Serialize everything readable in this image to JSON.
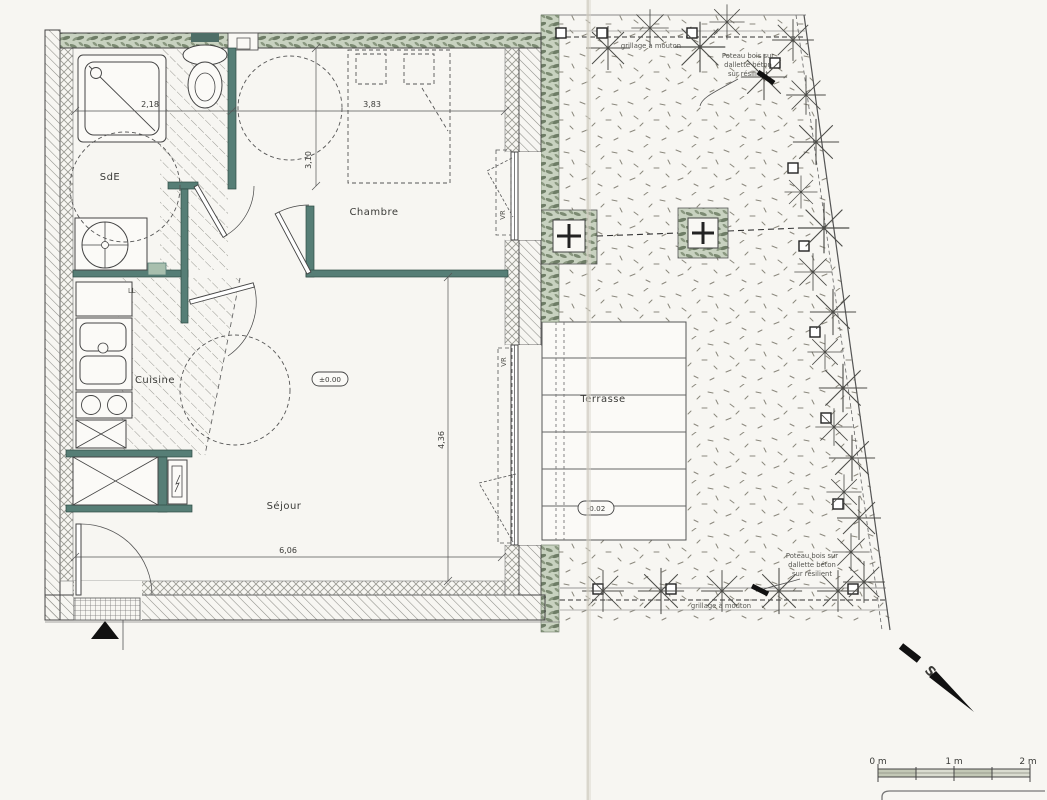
{
  "drawing": {
    "rooms": {
      "sde": "SdE",
      "chambre": "Chambre",
      "cuisine": "Cuisine",
      "sejour": "Séjour",
      "terrasse": "Terrasse"
    },
    "fixtures": {
      "washing_machine": "LL"
    },
    "dimensions": {
      "sde_width": "2,18",
      "chambre_width": "3,83",
      "chambre_depth": "3,10",
      "sejour_depth": "4,36",
      "sejour_width": "6,06"
    },
    "levels": {
      "ground_floor": "±0.00",
      "terrace": "-0.02"
    },
    "annotations": {
      "fence": "grillage à mouton",
      "post_line1": "Poteau bois sur",
      "post_line2": "dallette béton",
      "post_line3": "sur résilient",
      "roller_shutter": "VR"
    },
    "compass": {
      "south_letter": "S"
    },
    "scale_bar": {
      "zero": "0 m",
      "one": "1 m",
      "two": "2 m"
    },
    "colors": {
      "partition_wall": "#567e76",
      "hedge_green": "#b9c6ae",
      "paper": "#f7f6f2"
    }
  }
}
